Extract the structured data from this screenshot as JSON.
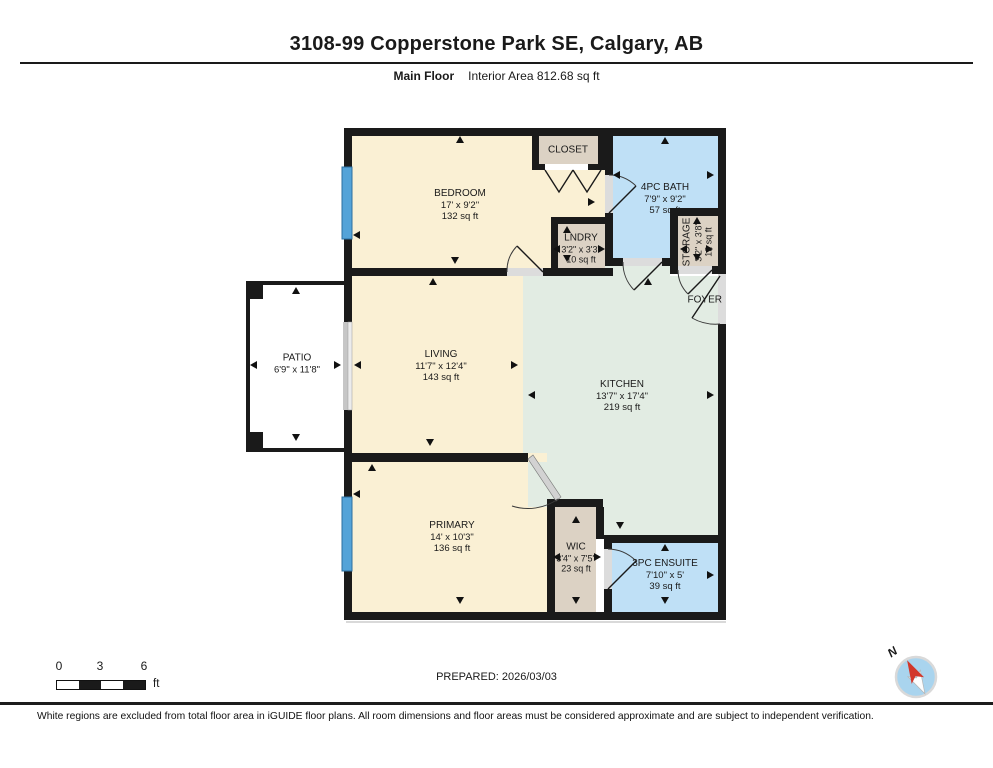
{
  "header": {
    "title": "3108-99 Copperstone Park SE, Calgary, AB",
    "floor_label": "Main Floor",
    "area_label": "Interior Area 812.68 sq ft"
  },
  "rooms": {
    "bedroom": {
      "name": "BEDROOM",
      "dims": "17' x 9'2\"",
      "area": "132 sq ft"
    },
    "closet": {
      "name": "CLOSET"
    },
    "bath": {
      "name": "4PC BATH",
      "dims": "7'9\" x 9'2\"",
      "area": "57 sq ft"
    },
    "laundry": {
      "name": "LNDRY",
      "dims": "3'2\" x 3'3\"",
      "area": "10 sq ft"
    },
    "storage": {
      "name": "STORAGE",
      "dims": "3'2\" x 3'8\"",
      "area": "12 sq ft"
    },
    "foyer": {
      "name": "FOYER"
    },
    "patio": {
      "name": "PATIO",
      "dims": "6'9\" x 11'8\""
    },
    "living": {
      "name": "LIVING",
      "dims": "11'7\" x 12'4\"",
      "area": "143 sq ft"
    },
    "kitchen": {
      "name": "KITCHEN",
      "dims": "13'7\" x 17'4\"",
      "area": "219 sq ft"
    },
    "primary": {
      "name": "PRIMARY",
      "dims": "14' x 10'3\"",
      "area": "136 sq ft"
    },
    "wic": {
      "name": "WIC",
      "dims": "3'4\" x 7'5\"",
      "area": "23 sq ft"
    },
    "ensuite": {
      "name": "3PC ENSUITE",
      "dims": "7'10\" x 5'",
      "area": "39 sq ft"
    }
  },
  "scale": {
    "ticks": [
      "0",
      "3",
      "6"
    ],
    "unit": "ft"
  },
  "compass": {
    "label": "N"
  },
  "footer": {
    "prepared": "PREPARED: 2026/03/03",
    "disclaimer": "White regions are excluded from total floor area in iGUIDE floor plans. All room dimensions and floor areas must be considered approximate and are subject to independent verification."
  },
  "colors": {
    "room_cream": "#faf0d4",
    "room_tan": "#dcd2c4",
    "room_blue": "#bfe0f6",
    "room_green": "#e2ece3",
    "window_blue": "#54a3d8",
    "wall_black": "#1a1a1a",
    "compass_blue": "#a9d4ee",
    "compass_red": "#d2372b"
  },
  "arrows": [
    {
      "d": "up",
      "x": 460,
      "y": 141
    },
    {
      "d": "left",
      "x": 357,
      "y": 236
    },
    {
      "d": "down",
      "x": 455,
      "y": 262
    },
    {
      "d": "right",
      "x": 592,
      "y": 203
    },
    {
      "d": "up",
      "x": 665,
      "y": 142
    },
    {
      "d": "left",
      "x": 617,
      "y": 176
    },
    {
      "d": "right",
      "x": 711,
      "y": 176
    },
    {
      "d": "up",
      "x": 567,
      "y": 231
    },
    {
      "d": "left",
      "x": 557,
      "y": 250
    },
    {
      "d": "right",
      "x": 602,
      "y": 250
    },
    {
      "d": "down",
      "x": 567,
      "y": 260
    },
    {
      "d": "up",
      "x": 697,
      "y": 222
    },
    {
      "d": "left",
      "x": 684,
      "y": 250
    },
    {
      "d": "right",
      "x": 710,
      "y": 250
    },
    {
      "d": "down",
      "x": 697,
      "y": 259
    },
    {
      "d": "up",
      "x": 296,
      "y": 292
    },
    {
      "d": "left",
      "x": 254,
      "y": 366
    },
    {
      "d": "right",
      "x": 338,
      "y": 366
    },
    {
      "d": "down",
      "x": 296,
      "y": 439
    },
    {
      "d": "up",
      "x": 433,
      "y": 283
    },
    {
      "d": "left",
      "x": 358,
      "y": 366
    },
    {
      "d": "right",
      "x": 515,
      "y": 366
    },
    {
      "d": "down",
      "x": 430,
      "y": 444
    },
    {
      "d": "up",
      "x": 648,
      "y": 283
    },
    {
      "d": "left",
      "x": 532,
      "y": 396
    },
    {
      "d": "right",
      "x": 711,
      "y": 396
    },
    {
      "d": "down",
      "x": 620,
      "y": 527
    },
    {
      "d": "up",
      "x": 372,
      "y": 469
    },
    {
      "d": "left",
      "x": 357,
      "y": 495
    },
    {
      "d": "down",
      "x": 460,
      "y": 602
    },
    {
      "d": "up",
      "x": 576,
      "y": 521
    },
    {
      "d": "left",
      "x": 557,
      "y": 558
    },
    {
      "d": "right",
      "x": 598,
      "y": 558
    },
    {
      "d": "down",
      "x": 576,
      "y": 602
    },
    {
      "d": "up",
      "x": 665,
      "y": 549
    },
    {
      "d": "right",
      "x": 711,
      "y": 576
    },
    {
      "d": "down",
      "x": 665,
      "y": 602
    }
  ]
}
